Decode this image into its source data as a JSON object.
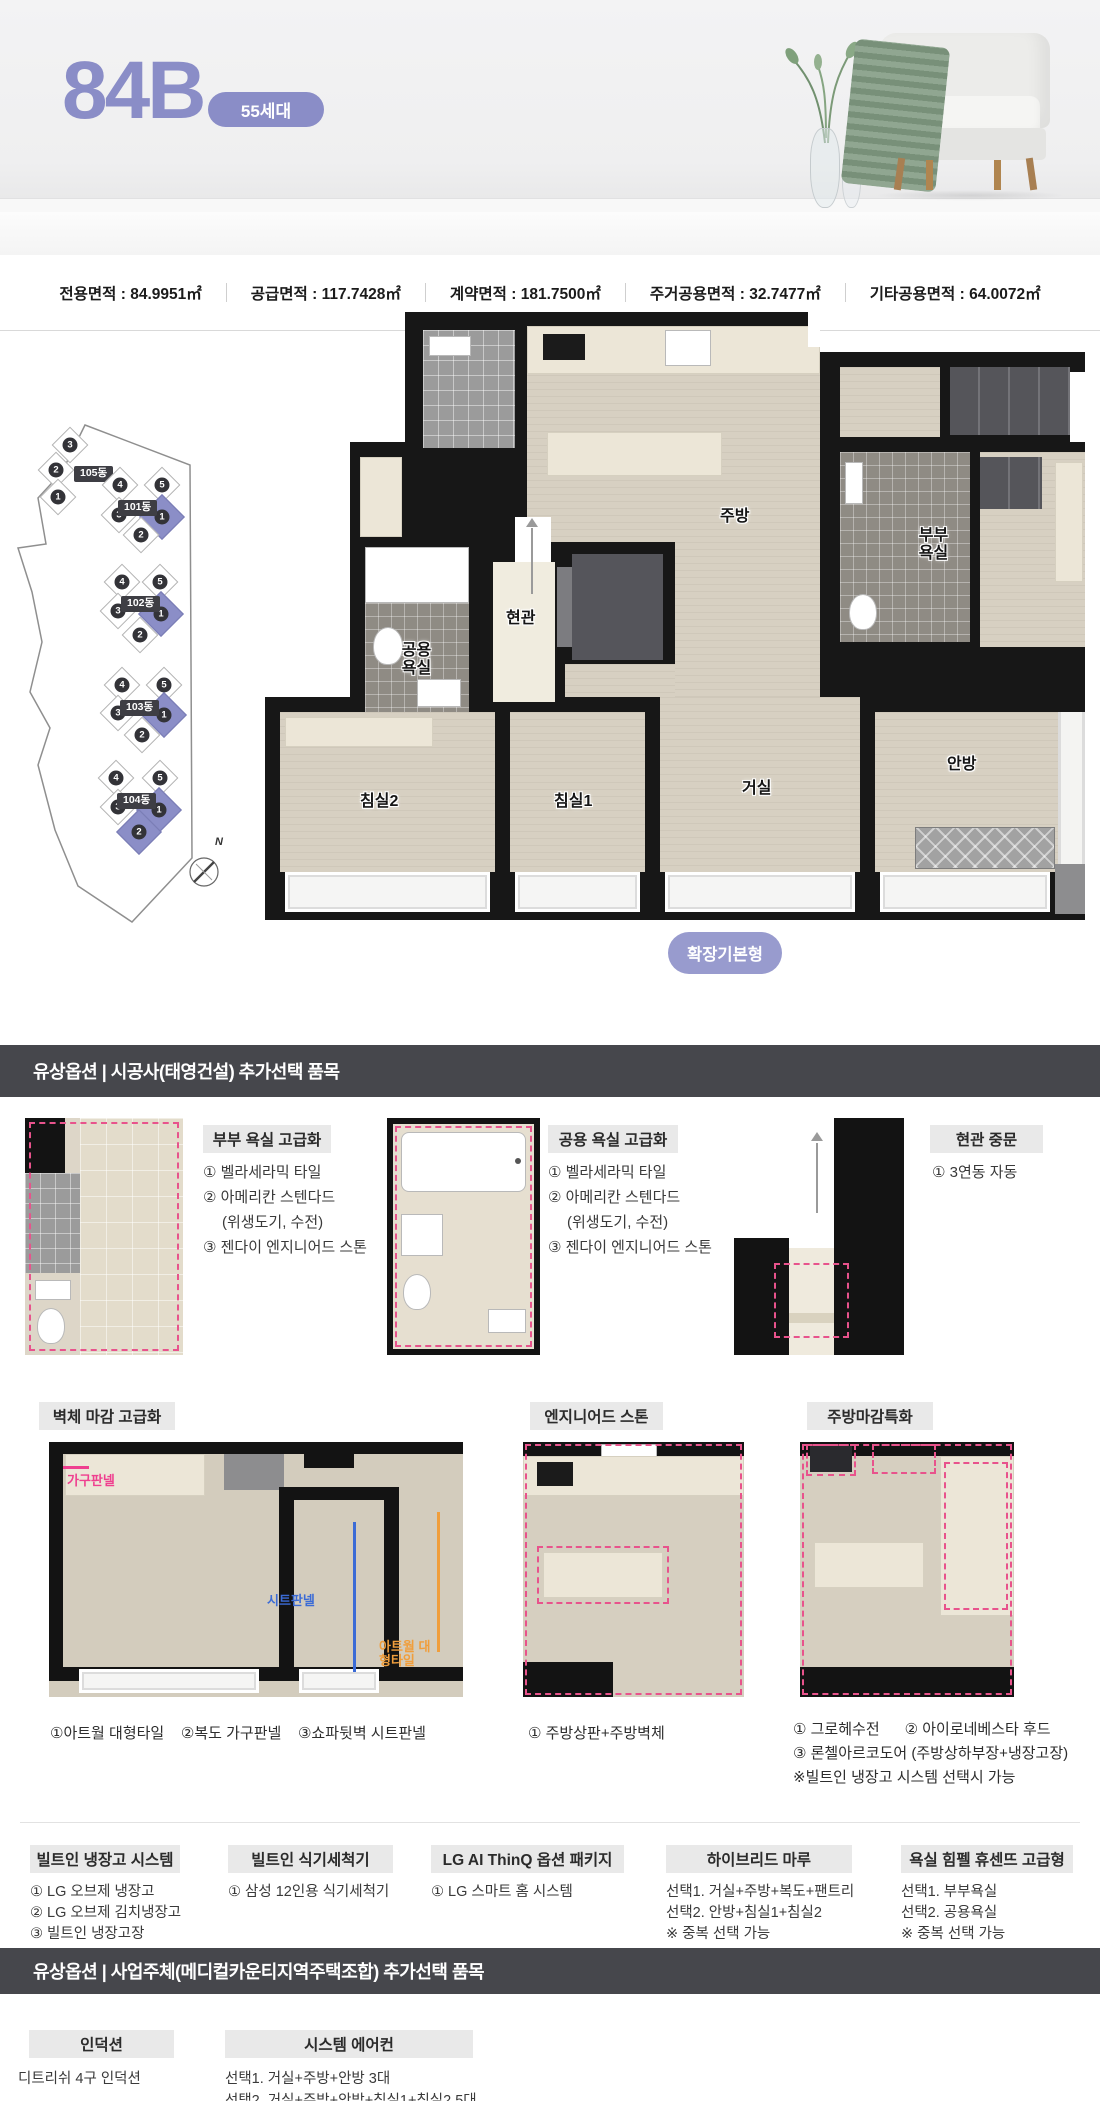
{
  "hero": {
    "unit_name": "84B",
    "badge": "55세대"
  },
  "area_bar": {
    "items": [
      {
        "label": "전용면적",
        "value": "84.9951㎡"
      },
      {
        "label": "공급면적",
        "value": "117.7428㎡"
      },
      {
        "label": "계약면적",
        "value": "181.7500㎡"
      },
      {
        "label": "주거공용면적",
        "value": "32.7477㎡"
      },
      {
        "label": "기타공용면적",
        "value": "64.0072㎡"
      }
    ]
  },
  "site_plan": {
    "compass": "N",
    "buildings": [
      {
        "name": "105동",
        "units": [
          {
            "n": "3"
          },
          {
            "n": "2"
          },
          {
            "n": "1"
          }
        ]
      },
      {
        "name": "101동",
        "units": [
          {
            "n": "4"
          },
          {
            "n": "5"
          },
          {
            "n": "3"
          },
          {
            "n": "1",
            "hl": true
          },
          {
            "n": "2"
          }
        ]
      },
      {
        "name": "102동",
        "units": [
          {
            "n": "4"
          },
          {
            "n": "5"
          },
          {
            "n": "3"
          },
          {
            "n": "1",
            "hl": true
          },
          {
            "n": "2"
          }
        ]
      },
      {
        "name": "103동",
        "units": [
          {
            "n": "4"
          },
          {
            "n": "5"
          },
          {
            "n": "3"
          },
          {
            "n": "1",
            "hl": true
          },
          {
            "n": "2"
          }
        ]
      },
      {
        "name": "104동",
        "units": [
          {
            "n": "4"
          },
          {
            "n": "5"
          },
          {
            "n": "3"
          },
          {
            "n": "1",
            "hl": true
          },
          {
            "n": "2",
            "hl": true
          }
        ]
      }
    ]
  },
  "floor_plan": {
    "rooms": {
      "kitchen": "주방",
      "entrance": "현관",
      "common_bath": "공용욕실",
      "master_bath": "부부욕실",
      "bedroom2": "침실2",
      "bedroom1": "침실1",
      "living": "거실",
      "master": "안방"
    },
    "expand_label": "확장기본형"
  },
  "section1": {
    "title": "유상옵션 | 시공사(태영건설) 추가선택 품목"
  },
  "row1": [
    {
      "title": "부부 욕실 고급화",
      "items": [
        "① 벨라세라믹 타일",
        "② 아메리칸 스텐다드",
        "(위생도기, 수전)",
        "③ 젠다이 엔지니어드 스톤"
      ]
    },
    {
      "title": "공용 욕실 고급화",
      "items": [
        "① 벨라세라믹 타일",
        "② 아메리칸 스텐다드",
        "(위생도기, 수전)",
        "③ 젠다이 엔지니어드 스톤"
      ]
    },
    {
      "title": "현관 중문",
      "items": [
        "① 3연동 자동"
      ]
    }
  ],
  "row2": [
    {
      "title": "벽체 마감 고급화",
      "labels": {
        "pink": "가구판넬",
        "blue": "시트판넬",
        "orange": "아트월 대형타일"
      },
      "caption": "①아트월 대형타일    ②복도 가구판넬    ③쇼파뒷벽 시트판넬"
    },
    {
      "title": "엔지니어드 스톤",
      "caption": "① 주방상판+주방벽체"
    },
    {
      "title": "주방마감특화",
      "caption_lines": [
        "① 그로헤수전      ② 아이로네베스타 후드",
        "③ 론첼아르코도어 (주방상하부장+냉장고장)",
        "※빌트인 냉장고 시스템 선택시 가능"
      ]
    }
  ],
  "row3": [
    {
      "title": "빌트인 냉장고 시스템",
      "items": [
        "① LG 오브제 냉장고",
        "② LG 오브제 김치냉장고",
        "③ 빌트인 냉장고장"
      ]
    },
    {
      "title": "빌트인 식기세척기",
      "items": [
        "① 삼성 12인용 식기세척기"
      ]
    },
    {
      "title": "LG AI ThinQ 옵션 패키지",
      "items": [
        "① LG 스마트 홈 시스템"
      ]
    },
    {
      "title": "하이브리드 마루",
      "items": [
        "선택1. 거실+주방+복도+팬트리",
        "선택2. 안방+침실1+침실2",
        "※ 중복 선택 가능"
      ]
    },
    {
      "title": "욕실 힘펠 휴센뜨 고급형",
      "items": [
        "선택1. 부부욕실",
        "선택2. 공용욕실",
        "※ 중복 선택 가능"
      ]
    }
  ],
  "section2": {
    "title": "유상옵션 | 사업주체(메디컬카운티지역주택조합) 추가선택 품목"
  },
  "row4": [
    {
      "title": "인덕션",
      "items": [
        "디트리쉬 4구 인덕션"
      ]
    },
    {
      "title": "시스템 에어컨",
      "items": [
        "선택1. 거실+주방+안방 3대",
        "선택2. 거실+주방+안방+침실1+침실2 5대"
      ]
    }
  ],
  "colors": {
    "accent": "#8a8dc7",
    "dark_bar": "#46474c",
    "highlight_pink": "#e8538c"
  }
}
